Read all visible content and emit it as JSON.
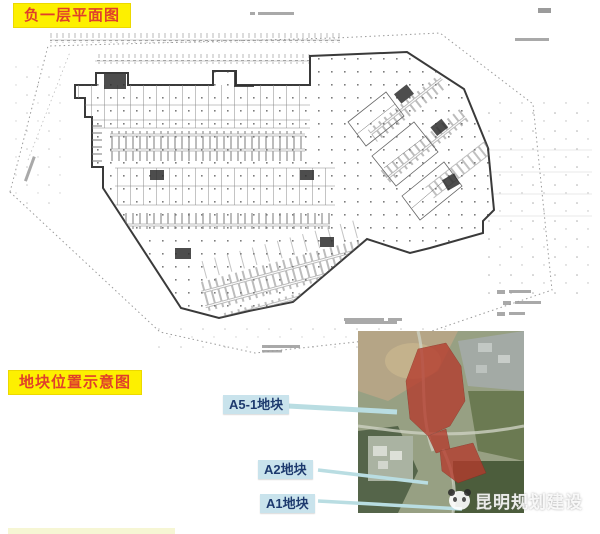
{
  "banners": {
    "plan_title": "负一层平面图",
    "location_title": "地块位置示意图"
  },
  "plot_labels": [
    {
      "label": "A5-1地块"
    },
    {
      "label": "A2地块"
    },
    {
      "label": "A1地块"
    }
  ],
  "watermark": {
    "text": "昆明规划建设",
    "icon": "panda-icon"
  },
  "colors": {
    "banner_bg": "#fdf000",
    "banner_text": "#e0402a",
    "plot_label_bg": "#c9e3ec",
    "plot_label_text": "#1d3a6e",
    "leader_line": "#b9dde2",
    "plan_line": "#3a3a3a",
    "site_dash_line": "#9a9a9a",
    "plot_highlight_red": "#b43a2c"
  }
}
